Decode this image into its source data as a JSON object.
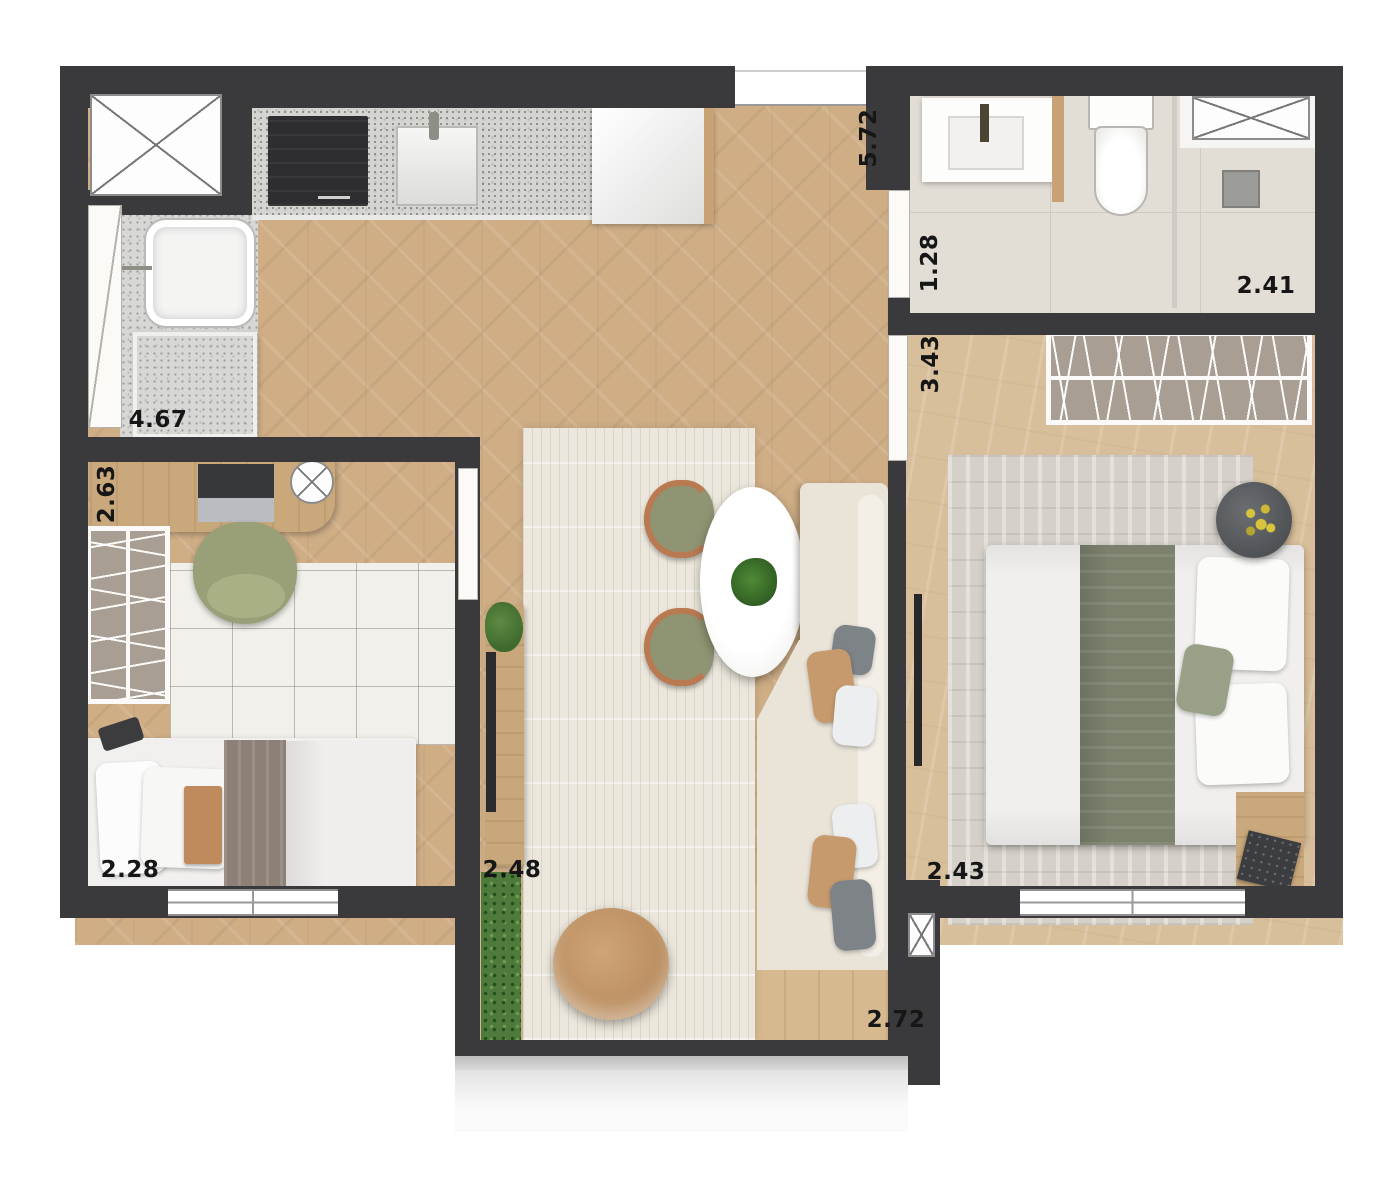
{
  "plan": {
    "dimensions": [
      {
        "text": "5.72",
        "orientation": "vertical"
      },
      {
        "text": "1.28",
        "orientation": "vertical"
      },
      {
        "text": "2.41",
        "orientation": "horizontal"
      },
      {
        "text": "3.43",
        "orientation": "vertical"
      },
      {
        "text": "4.67",
        "orientation": "horizontal"
      },
      {
        "text": "2.63",
        "orientation": "vertical"
      },
      {
        "text": "2.28",
        "orizontal": "horizontal",
        "orientation": "horizontal"
      },
      {
        "text": "2.48",
        "orientation": "horizontal"
      },
      {
        "text": "2.43",
        "orientation": "horizontal"
      },
      {
        "text": "2.72",
        "orientation": "horizontal"
      }
    ],
    "colors": {
      "wall": "#3a3a3d",
      "living_floor": "#cfae86",
      "bedroom_floor": "#d8bf9b",
      "bathroom_tile": "#e2ddd5",
      "rug_cream": "#ece7dc",
      "sofa": "#e9e3d8",
      "accent_olive": "#8f9573",
      "accent_tan": "#c49a6c",
      "grass": "#4e7a3c"
    }
  }
}
